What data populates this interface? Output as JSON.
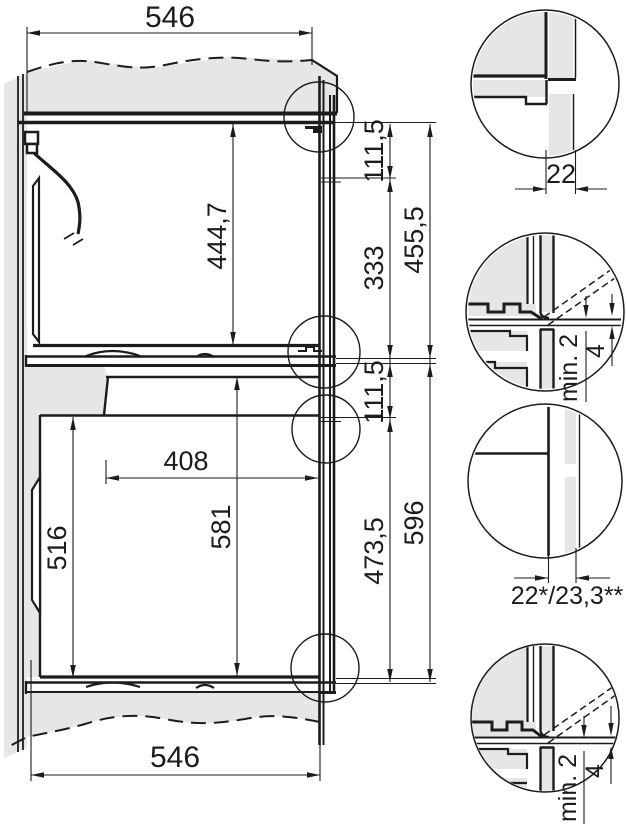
{
  "colors": {
    "line": "#1c1c1c",
    "panel_gray": "#e6e6e6",
    "background": "#ffffff"
  },
  "main_drawing": {
    "dims": {
      "top_width": "546",
      "bottom_width": "546",
      "upper_cavity_height": "444,7",
      "upper_front_panel": "111,5",
      "upper_rear_section": "333",
      "upper_total_height": "455,5",
      "lower_front_panel": "111,5",
      "lower_rear_section": "473,5",
      "lower_total_height": "596",
      "lower_cavity_depth": "408",
      "lower_cavity_front_height": "516",
      "lower_cavity_rear_height": "581"
    }
  },
  "details": {
    "top_edge": {
      "gap": "22"
    },
    "upper_junction": {
      "min_clearance": "min. 2",
      "strip": "4"
    },
    "side_panel": {
      "thickness": "22*/23,3**"
    },
    "lower_junction": {
      "min_clearance": "min. 2",
      "strip": "4"
    }
  }
}
